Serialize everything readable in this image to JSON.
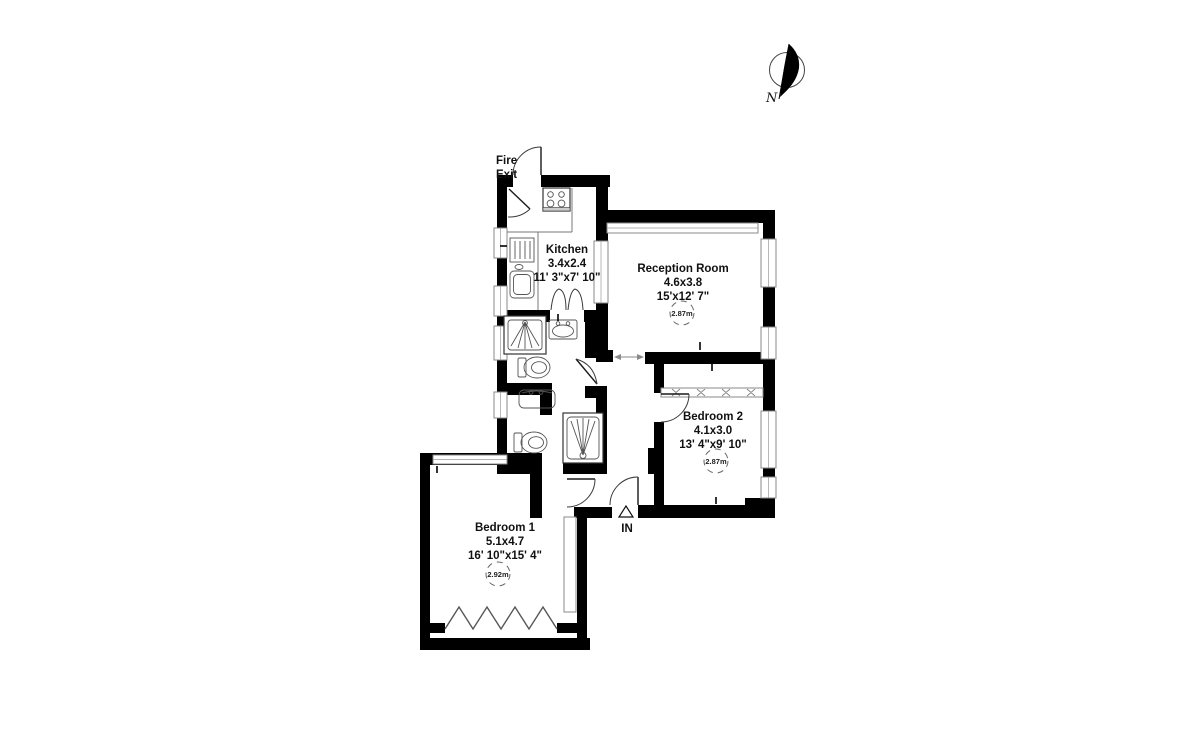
{
  "compass": {
    "label": "N"
  },
  "fire_exit": {
    "line1": "Fire",
    "line2": "Exit"
  },
  "entrance": {
    "label": "IN"
  },
  "rooms": {
    "kitchen": {
      "name": "Kitchen",
      "metric": "3.4x2.4",
      "imperial": "11' 3\"x7' 10\""
    },
    "reception": {
      "name": "Reception Room",
      "metric": "4.6x3.8",
      "imperial": "15'x12' 7\"",
      "ceiling": "2.87m"
    },
    "bedroom2": {
      "name": "Bedroom 2",
      "metric": "4.1x3.0",
      "imperial": "13' 4\"x9' 10\"",
      "ceiling": "2.87m"
    },
    "bedroom1": {
      "name": "Bedroom 1",
      "metric": "5.1x4.7",
      "imperial": "16' 10\"x15' 4\"",
      "ceiling": "2.92m"
    }
  },
  "colors": {
    "wall": "#000000",
    "background": "#ffffff",
    "fixture_stroke": "#444444"
  }
}
